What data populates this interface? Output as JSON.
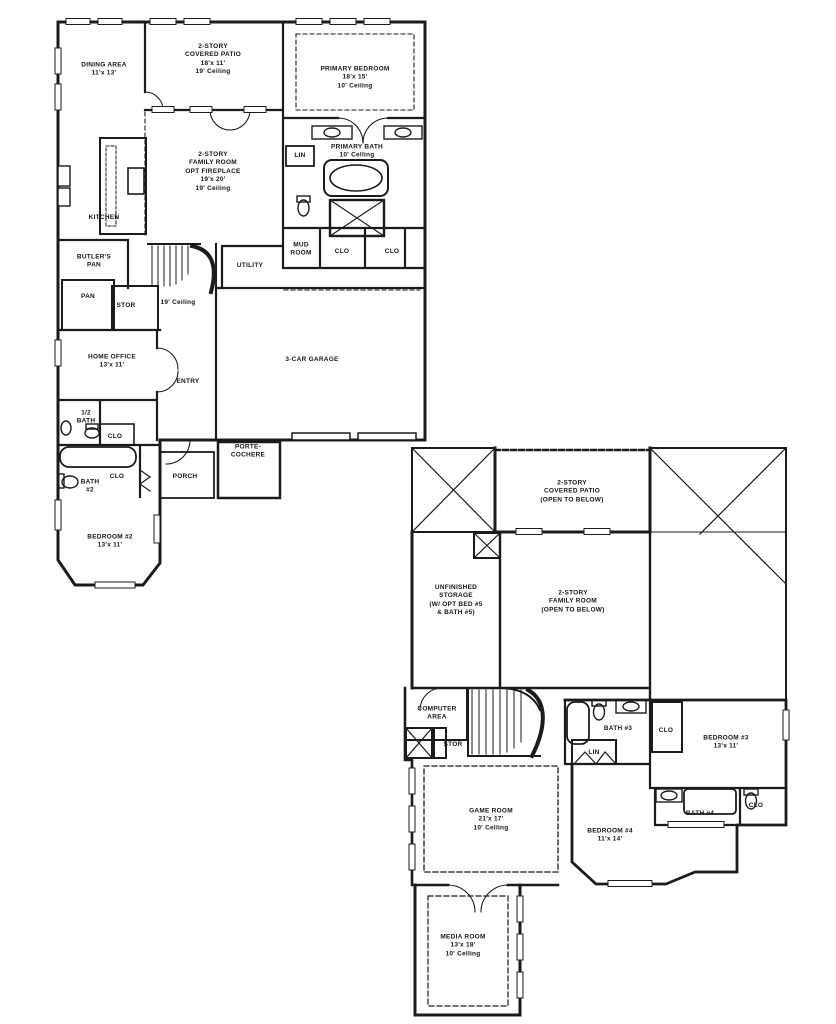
{
  "document": {
    "type": "residential floor plan",
    "floors": [
      "first floor",
      "second floor"
    ],
    "colors": {
      "ink": "#1b1b1b",
      "background": "#ffffff"
    }
  },
  "rooms": [
    {
      "name": "dining-area-label",
      "floor": 1,
      "lines": [
        "DINING AREA",
        "11'x 13'"
      ],
      "x": 104,
      "y": 70
    },
    {
      "name": "covered-patio-label",
      "floor": 1,
      "lines": [
        "2-STORY",
        "COVERED PATIO",
        "18'x 11'",
        "19' Ceiling"
      ],
      "x": 213,
      "y": 60
    },
    {
      "name": "primary-bedroom-label",
      "floor": 1,
      "lines": [
        "PRIMARY BEDROOM",
        "18'x 15'",
        "10' Ceiling"
      ],
      "x": 355,
      "y": 78
    },
    {
      "name": "family-room-label",
      "floor": 1,
      "lines": [
        "2-STORY",
        "FAMILY ROOM",
        "OPT  FIREPLACE",
        "19'x 20'",
        "19' Ceiling"
      ],
      "x": 213,
      "y": 172
    },
    {
      "name": "kitchen-label",
      "floor": 1,
      "lines": [
        "KITCHEN"
      ],
      "x": 104,
      "y": 218
    },
    {
      "name": "primary-bath-label",
      "floor": 1,
      "lines": [
        "PRIMARY BATH",
        "10' Celling"
      ],
      "x": 357,
      "y": 152
    },
    {
      "name": "linen-1-label",
      "floor": 1,
      "lines": [
        "LIN"
      ],
      "x": 300,
      "y": 156
    },
    {
      "name": "butlers-pantry-label",
      "floor": 1,
      "lines": [
        "BUTLER'S",
        "PAN"
      ],
      "x": 94,
      "y": 262
    },
    {
      "name": "pan-label",
      "floor": 1,
      "lines": [
        "PAN"
      ],
      "x": 88,
      "y": 297
    },
    {
      "name": "stor-1-label",
      "floor": 1,
      "lines": [
        "STOR"
      ],
      "x": 126,
      "y": 306
    },
    {
      "name": "stair-ceiling-label",
      "floor": 1,
      "lines": [
        "19' Ceiling"
      ],
      "x": 178,
      "y": 303
    },
    {
      "name": "utility-label",
      "floor": 1,
      "lines": [
        "UTILITY"
      ],
      "x": 250,
      "y": 266
    },
    {
      "name": "mud-room-label",
      "floor": 1,
      "lines": [
        "MUD",
        "ROOM"
      ],
      "x": 301,
      "y": 250
    },
    {
      "name": "clo-1-label",
      "floor": 1,
      "lines": [
        "CLO"
      ],
      "x": 342,
      "y": 252
    },
    {
      "name": "clo-2-label",
      "floor": 1,
      "lines": [
        "CLO"
      ],
      "x": 392,
      "y": 252
    },
    {
      "name": "home-office-label",
      "floor": 1,
      "lines": [
        "HOME OFFICE",
        "13'x 11'"
      ],
      "x": 112,
      "y": 362
    },
    {
      "name": "entry-label",
      "floor": 1,
      "lines": [
        "ENTRY"
      ],
      "x": 188,
      "y": 382
    },
    {
      "name": "garage-label",
      "floor": 1,
      "lines": [
        "3-CAR GARAGE"
      ],
      "x": 312,
      "y": 360
    },
    {
      "name": "half-bath-label",
      "floor": 1,
      "lines": [
        "1/2",
        "BATH"
      ],
      "x": 86,
      "y": 418
    },
    {
      "name": "clo-3-label",
      "floor": 1,
      "lines": [
        "CLO"
      ],
      "x": 115,
      "y": 437
    },
    {
      "name": "clo-4-label",
      "floor": 1,
      "lines": [
        "CLO"
      ],
      "x": 117,
      "y": 477
    },
    {
      "name": "bath-2-label",
      "floor": 1,
      "lines": [
        "BATH",
        "#2"
      ],
      "x": 90,
      "y": 487
    },
    {
      "name": "porch-label",
      "floor": 1,
      "lines": [
        "PORCH"
      ],
      "x": 185,
      "y": 477
    },
    {
      "name": "porte-cochere-label",
      "floor": 1,
      "lines": [
        "PORTE-",
        "COCHERE"
      ],
      "x": 248,
      "y": 452
    },
    {
      "name": "bedroom-2-label",
      "floor": 1,
      "lines": [
        "BEDROOM #2",
        "13'x 11'"
      ],
      "x": 110,
      "y": 542
    },
    {
      "name": "covered-patio-2-label",
      "floor": 2,
      "lines": [
        "2-STORY",
        "COVERED PATIO",
        "(OPEN TO BELOW)"
      ],
      "x": 572,
      "y": 492
    },
    {
      "name": "unfinished-storage-label",
      "floor": 2,
      "lines": [
        "UNFINISHED",
        "STORAGE",
        "(W/ OPT  BED #5",
        "& BATH #5)"
      ],
      "x": 456,
      "y": 601
    },
    {
      "name": "family-room-2-label",
      "floor": 2,
      "lines": [
        "2-STORY",
        "FAMILY ROOM",
        "(OPEN TO BELOW)"
      ],
      "x": 573,
      "y": 602
    },
    {
      "name": "computer-area-label",
      "floor": 2,
      "lines": [
        "COMPUTER",
        "AREA"
      ],
      "x": 437,
      "y": 714
    },
    {
      "name": "stor-2-label",
      "floor": 2,
      "lines": [
        "STOR"
      ],
      "x": 453,
      "y": 745
    },
    {
      "name": "linen-2-label",
      "floor": 2,
      "lines": [
        "LIN"
      ],
      "x": 594,
      "y": 753
    },
    {
      "name": "bath-3-label",
      "floor": 2,
      "lines": [
        "BATH #3"
      ],
      "x": 618,
      "y": 729
    },
    {
      "name": "clo-5-label",
      "floor": 2,
      "lines": [
        "CLO"
      ],
      "x": 666,
      "y": 731
    },
    {
      "name": "bedroom-3-label",
      "floor": 2,
      "lines": [
        "BEDROOM #3",
        "13'x 11'"
      ],
      "x": 726,
      "y": 743
    },
    {
      "name": "game-room-label",
      "floor": 2,
      "lines": [
        "GAME ROOM",
        "21'x 17'",
        "10' Celling"
      ],
      "x": 491,
      "y": 820
    },
    {
      "name": "bedroom-4-label",
      "floor": 2,
      "lines": [
        "BEDROOM #4",
        "11'x 14'"
      ],
      "x": 610,
      "y": 836
    },
    {
      "name": "bath-4-label",
      "floor": 2,
      "lines": [
        "BATH #4"
      ],
      "x": 700,
      "y": 814
    },
    {
      "name": "clo-6-label",
      "floor": 2,
      "lines": [
        "CLO"
      ],
      "x": 756,
      "y": 806
    },
    {
      "name": "media-room-label",
      "floor": 2,
      "lines": [
        "MEDIA ROOM",
        "13'x 18'",
        "10' Celling"
      ],
      "x": 463,
      "y": 946
    }
  ]
}
